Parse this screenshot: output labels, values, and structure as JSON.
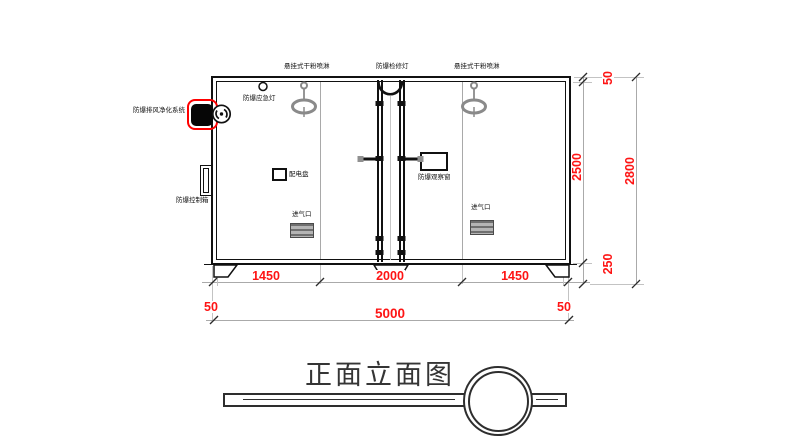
{
  "title": "正面立面图",
  "colors": {
    "dimension_text": "#fe1414",
    "highlight_box": "#ff0000",
    "line": "#111111",
    "aux_line": "#aaaaaa",
    "sprinkler": "#8a8a8a"
  },
  "labels": {
    "sprinkler_left": "悬挂式干粉喷淋",
    "inspection_light": "防爆检修灯",
    "sprinkler_right": "悬挂式干粉喷淋",
    "emergency_light": "防爆应急灯",
    "exhaust_purification": "防爆排风净化系统",
    "control_box": "防爆控制箱",
    "distribution_panel": "配电盘",
    "observation_window": "防爆观察窗",
    "air_inlet_left": "进气口",
    "air_inlet_right": "进气口"
  },
  "dimensions": {
    "bottom_segments": [
      "1450",
      "2000",
      "1450"
    ],
    "bottom_margin_left": "50",
    "bottom_total": "5000",
    "bottom_margin_right": "50",
    "right_top_margin": "50",
    "right_inner_height": "2500",
    "right_base_height": "250",
    "right_total_height": "2800"
  }
}
